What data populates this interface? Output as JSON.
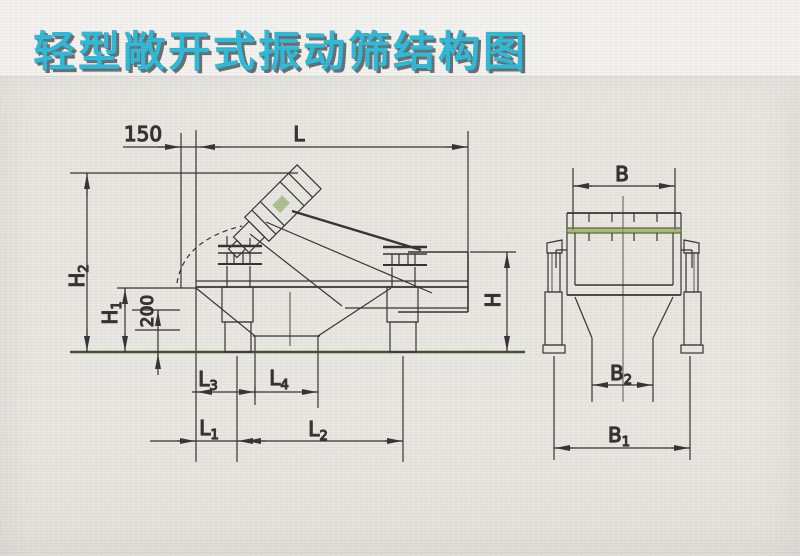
{
  "title": "轻型敞开式振动筛结构图",
  "colors": {
    "title_fill": "#28b9d9",
    "title_shadow": "#676a6e",
    "line": "#2f2f2f",
    "accent_green": "#7d9a4a",
    "background": "#e9e7e2"
  },
  "side_view": {
    "dim_offset": "150",
    "dim_length": "L",
    "dim_h2": {
      "base": "H",
      "sub": "2"
    },
    "dim_h1": {
      "base": "H",
      "sub": "1"
    },
    "dim_200": "200",
    "dim_h": "H",
    "dim_l3": {
      "base": "L",
      "sub": "3"
    },
    "dim_l4": {
      "base": "L",
      "sub": "4"
    },
    "dim_l1": {
      "base": "L",
      "sub": "1"
    },
    "dim_l2": {
      "base": "L",
      "sub": "2"
    }
  },
  "front_view": {
    "dim_b": {
      "base": "B",
      "sub": ""
    },
    "dim_b2": {
      "base": "B",
      "sub": "2"
    },
    "dim_b1": {
      "base": "B",
      "sub": "1"
    }
  }
}
